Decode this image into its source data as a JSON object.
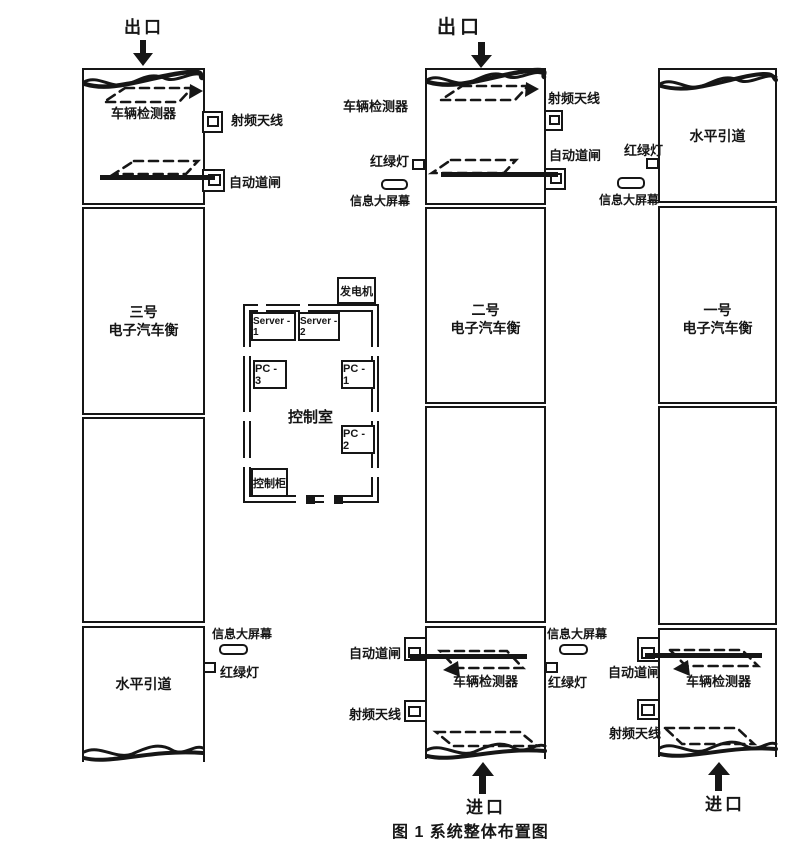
{
  "figure": {
    "caption": "图 1 系统整体布置图"
  },
  "labels": {
    "exit": "出口",
    "entrance": "进口",
    "vehicle_detector": "车辆检测器",
    "rf_antenna": "射频天线",
    "auto_barrier": "自动道闸",
    "traffic_light": "红绿灯",
    "info_screen": "信息大屏幕",
    "level_approach": "水平引道"
  },
  "lanes": [
    {
      "number": "三号",
      "type": "电子汽车衡"
    },
    {
      "number": "二号",
      "type": "电子汽车衡"
    },
    {
      "number": "一号",
      "type": "电子汽车衡"
    }
  ],
  "control_room": {
    "name": "控制室",
    "generator": "发电机",
    "server1": "Server - 1",
    "server2": "Server - 2",
    "pc1": "PC - 1",
    "pc2": "PC - 2",
    "pc3": "PC - 3",
    "cabinet": "控制柜"
  },
  "colors": {
    "ink": "#161616",
    "paper": "#ffffff"
  }
}
